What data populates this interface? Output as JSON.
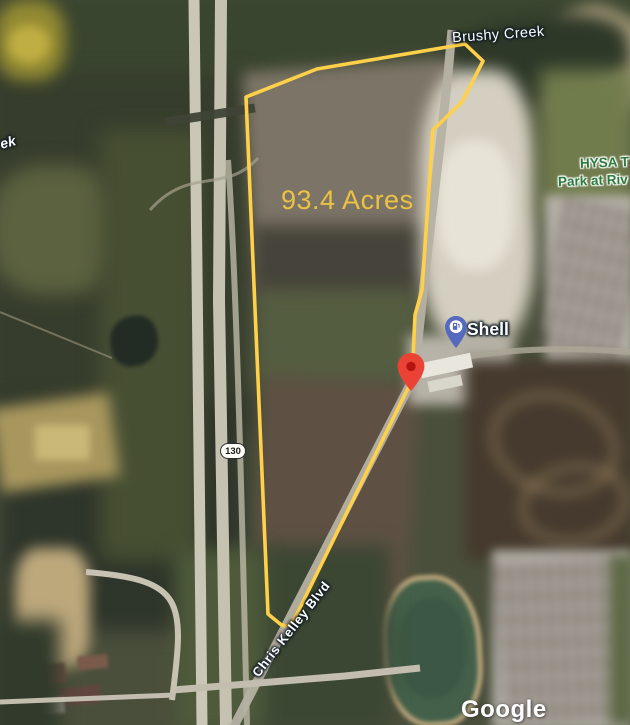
{
  "map": {
    "type": "satellite",
    "attribution": "Google",
    "parcel": {
      "acreage_label": "93.4 Acres",
      "outline_color": "#FFD04A",
      "acreage_text_color": "#ECC243"
    },
    "labels": {
      "creek": "Brushy Creek",
      "creek_partial": "ek",
      "road": "Chris Kelley Blvd",
      "park_line1": "HYSA T",
      "park_line2": "Park at Riv",
      "highway_shield": "130",
      "gas_station": "Shell"
    },
    "markers": {
      "gas_station_pin": {
        "name": "Shell",
        "color": "#5569BE"
      },
      "location_pin": {
        "color": "#EA4335",
        "dot_color": "#B31412"
      }
    },
    "colors": {
      "park_label_text": "#2B7A3D",
      "map_label_text": "#FFFFFF"
    }
  }
}
